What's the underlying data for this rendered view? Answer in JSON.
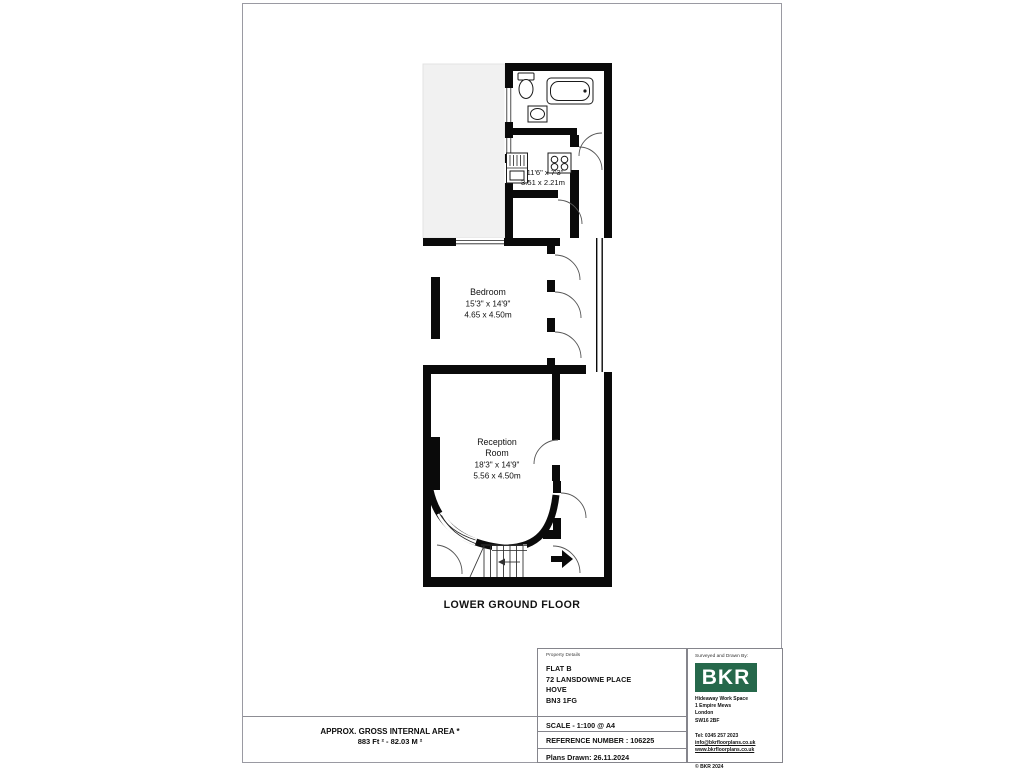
{
  "plan": {
    "floor_label": "LOWER GROUND FLOOR",
    "area_note_line1": "APPROX. GROSS INTERNAL AREA *",
    "area_note_line2": "883 Ft ²  -  82.03 M ²",
    "rooms": {
      "kitchen": {
        "dim_imperial": "11'6\" x 7'3\"",
        "dim_metric": "3.51 x 2.21m"
      },
      "bedroom": {
        "name": "Bedroom",
        "dim_imperial": "15'3\" x 14'9\"",
        "dim_metric": "4.65 x 4.50m"
      },
      "reception": {
        "name_line1": "Reception",
        "name_line2": "Room",
        "dim_imperial": "18'3\" x 14'9\"",
        "dim_metric": "5.56 x 4.50m"
      }
    }
  },
  "property_details": {
    "heading": "Property Details",
    "address_line1": "FLAT B",
    "address_line2": "72 LANSDOWNE PLACE",
    "address_line3": "HOVE",
    "address_line4": "BN3 1FG",
    "scale": "SCALE - 1:100 @ A4",
    "reference": "REFERENCE NUMBER : 106225",
    "plans_drawn": "Plans Drawn: 26.11.2024"
  },
  "surveyor": {
    "heading": "Surveyed and Drawn By:",
    "logo_text": "BKR",
    "address_line1": "Hideaway Work Space",
    "address_line2": "1 Empire Mews",
    "address_line3": "London",
    "address_line4": "SW16 2BF",
    "telephone": "Tel:   0345 257 2023",
    "email": "info@bkrfloorplans.co.uk",
    "website": "www.bkrfloorplans.co.uk",
    "copyright": "©  BKR 2024"
  },
  "colors": {
    "wall": "#0a0a0a",
    "terrace_fill": "#f1f1f1",
    "logo_green": "#26684b",
    "page_border": "#9a9aa2"
  }
}
